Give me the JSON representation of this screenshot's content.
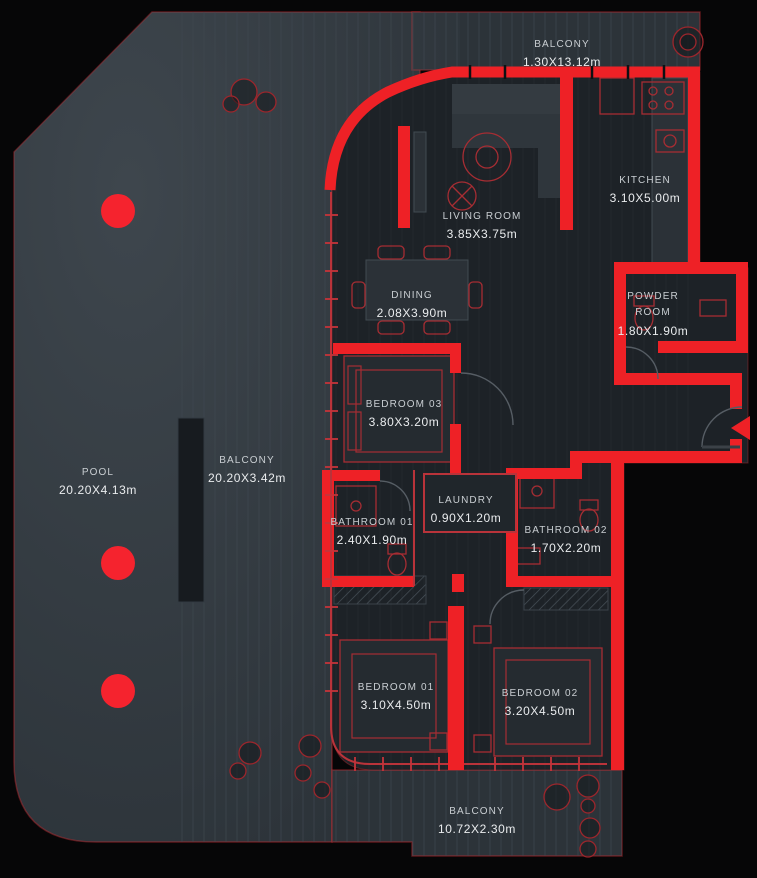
{
  "colors": {
    "background": "#060607",
    "deck": "#2c3339",
    "interior": "#1d2227",
    "wall_red": "#ee2126",
    "accent_red": "#f5232e",
    "outline_red": "#b9333a",
    "text_dim": "#c9ced2",
    "text_bright": "#eaecee"
  },
  "rooms": [
    {
      "id": "balcony-top",
      "name": "BALCONY",
      "dims": "1.30X13.12m"
    },
    {
      "id": "kitchen",
      "name": "KITCHEN",
      "dims": "3.10X5.00m"
    },
    {
      "id": "living-room",
      "name": "LIVING ROOM",
      "dims": "3.85X3.75m"
    },
    {
      "id": "dining",
      "name": "DINING",
      "dims": "2.08X3.90m"
    },
    {
      "id": "powder-room",
      "name": "POWDER ROOM",
      "dims": "1.80X1.90m"
    },
    {
      "id": "bedroom-03",
      "name": "BEDROOM 03",
      "dims": "3.80X3.20m"
    },
    {
      "id": "laundry",
      "name": "LAUNDRY",
      "dims": "0.90X1.20m"
    },
    {
      "id": "bathroom-01",
      "name": "BATHROOM 01",
      "dims": "2.40X1.90m"
    },
    {
      "id": "bathroom-02",
      "name": "BATHROOM 02",
      "dims": "1.70X2.20m"
    },
    {
      "id": "bedroom-01",
      "name": "BEDROOM 01",
      "dims": "3.10X4.50m"
    },
    {
      "id": "bedroom-02",
      "name": "BEDROOM 02",
      "dims": "3.20X4.50m"
    },
    {
      "id": "balcony-bottom",
      "name": "BALCONY",
      "dims": "10.72X2.30m"
    },
    {
      "id": "pool",
      "name": "POOL",
      "dims": "20.20X4.13m"
    },
    {
      "id": "balcony-left",
      "name": "BALCONY",
      "dims": "20.20X3.42m"
    }
  ]
}
